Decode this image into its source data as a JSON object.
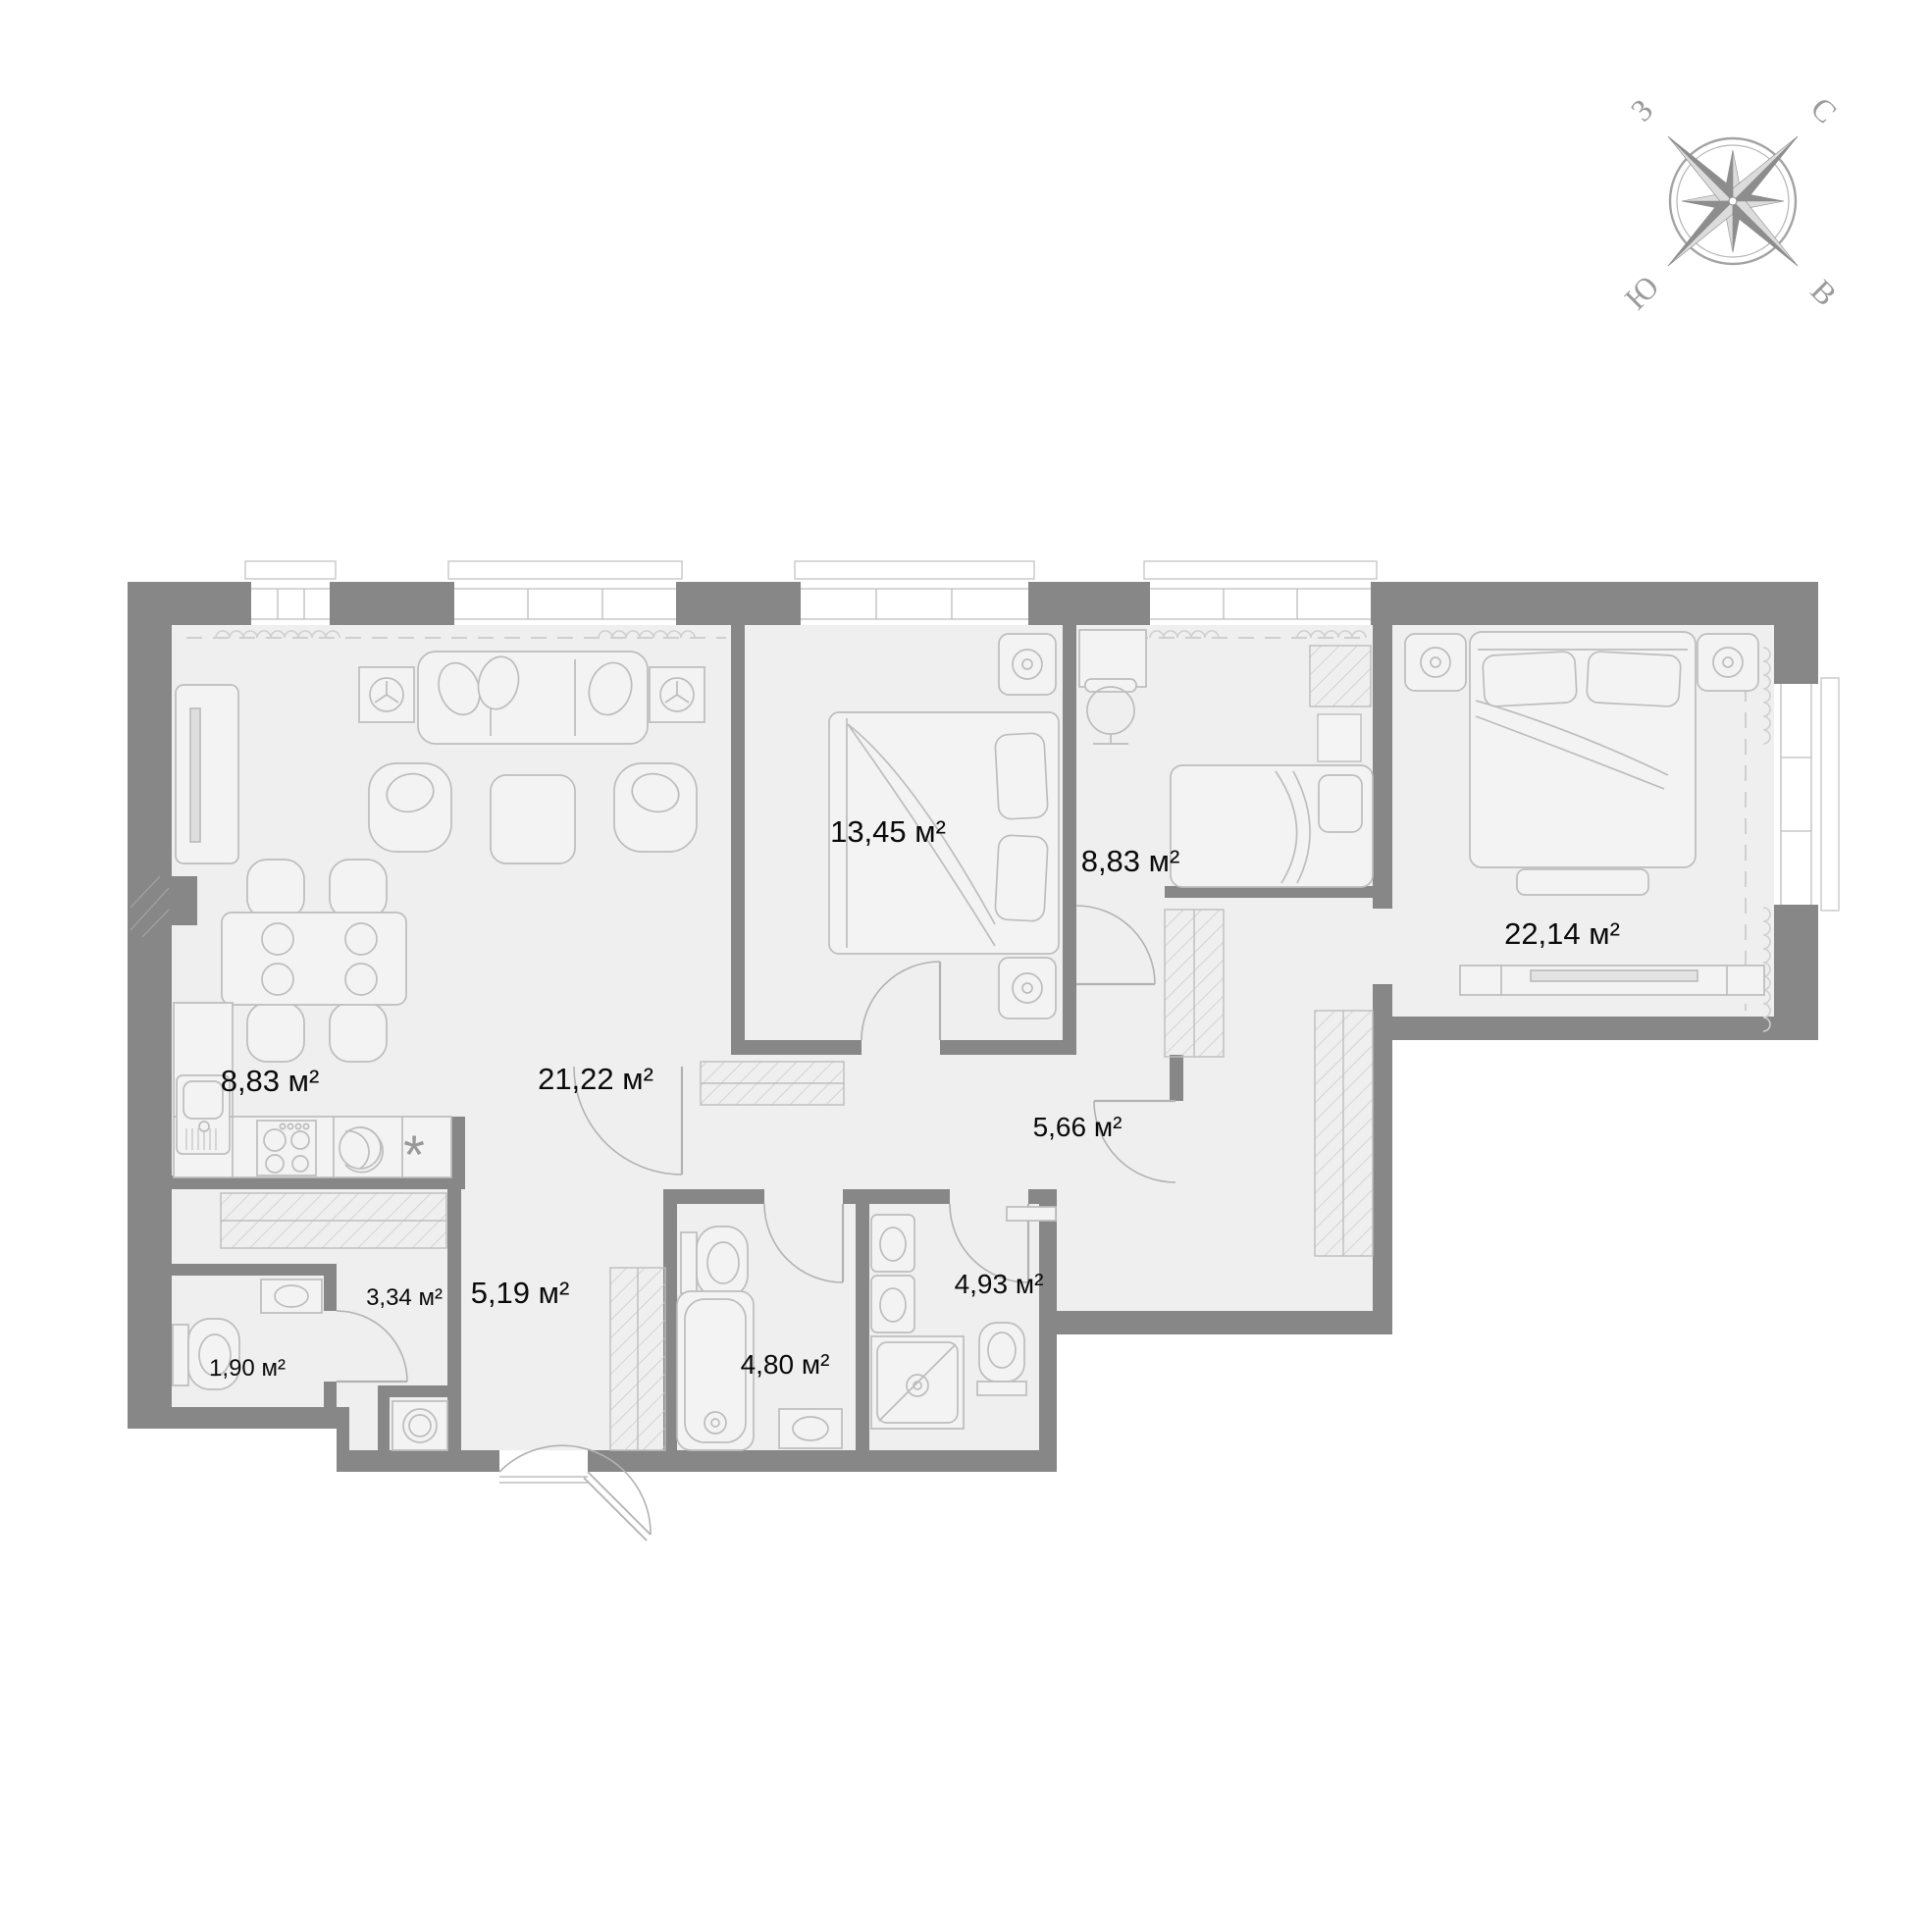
{
  "plan": {
    "area_unit": "м²",
    "kitchen_star": "*",
    "rooms": {
      "kitchen": {
        "area": "8,83 м²"
      },
      "living": {
        "area": "21,22 м²"
      },
      "bedroom1": {
        "area": "13,45 м²"
      },
      "office": {
        "area": "8,83 м²"
      },
      "master": {
        "area": "22,14 м²"
      },
      "hall": {
        "area": "5,66 м²"
      },
      "bath1": {
        "area": "4,80 м²"
      },
      "bath2": {
        "area": "4,93 м²"
      },
      "entry": {
        "area": "5,19 м²"
      },
      "wardrobe": {
        "area": "3,34 м²"
      },
      "wc": {
        "area": "1,90 м²"
      }
    }
  },
  "compass": {
    "west": "З",
    "north": "С",
    "south": "Ю",
    "east": "В"
  },
  "colors": {
    "wall": "#878787",
    "floor": "#efefef",
    "furniture_line": "#bdbdbd",
    "label_text": "#0a0a0a",
    "compass_gray": "#9b9b9b"
  }
}
